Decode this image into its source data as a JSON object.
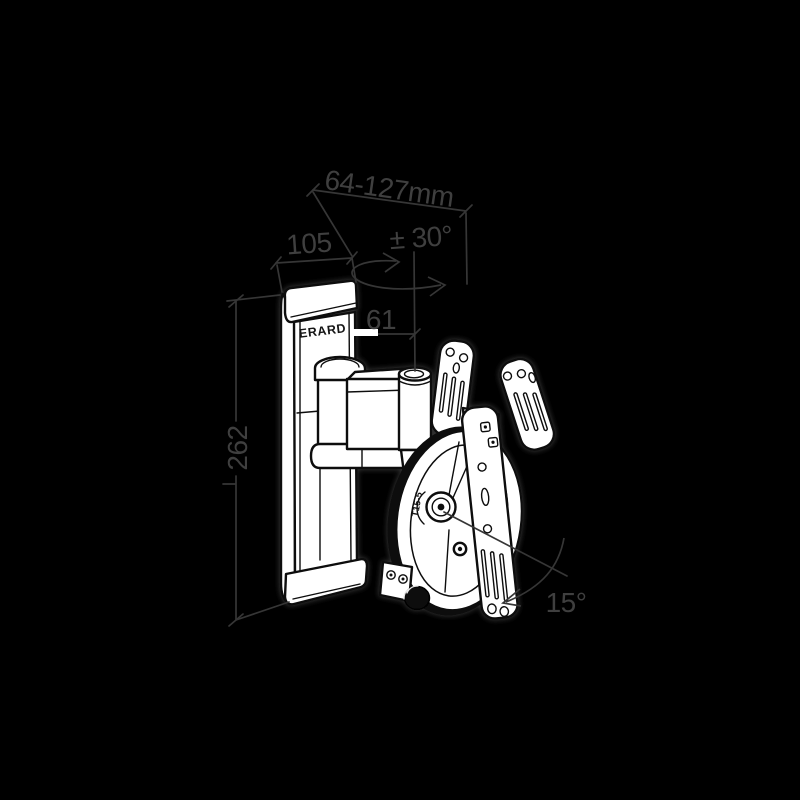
{
  "scene": {
    "background": "#000000",
    "art": {
      "fill": "#ffffff",
      "stroke": "#0a0a0a",
      "halo": "#3c3c3c",
      "knob_fill": "#0c0c0c"
    },
    "dimensions_style": {
      "line_color": "#363636",
      "text_color": "#3f3f3f"
    }
  },
  "annotations": {
    "width_range": {
      "text": "64-127mm"
    },
    "plate_width": {
      "text": "105"
    },
    "swivel_range": {
      "text": "± 30°"
    },
    "arm_offset": {
      "text": "61"
    },
    "plate_height": {
      "text": "262"
    },
    "tilt_range": {
      "text": "15°"
    }
  },
  "part_labels": {
    "brand": "ERARD",
    "pivot_marking": "T15-5"
  }
}
